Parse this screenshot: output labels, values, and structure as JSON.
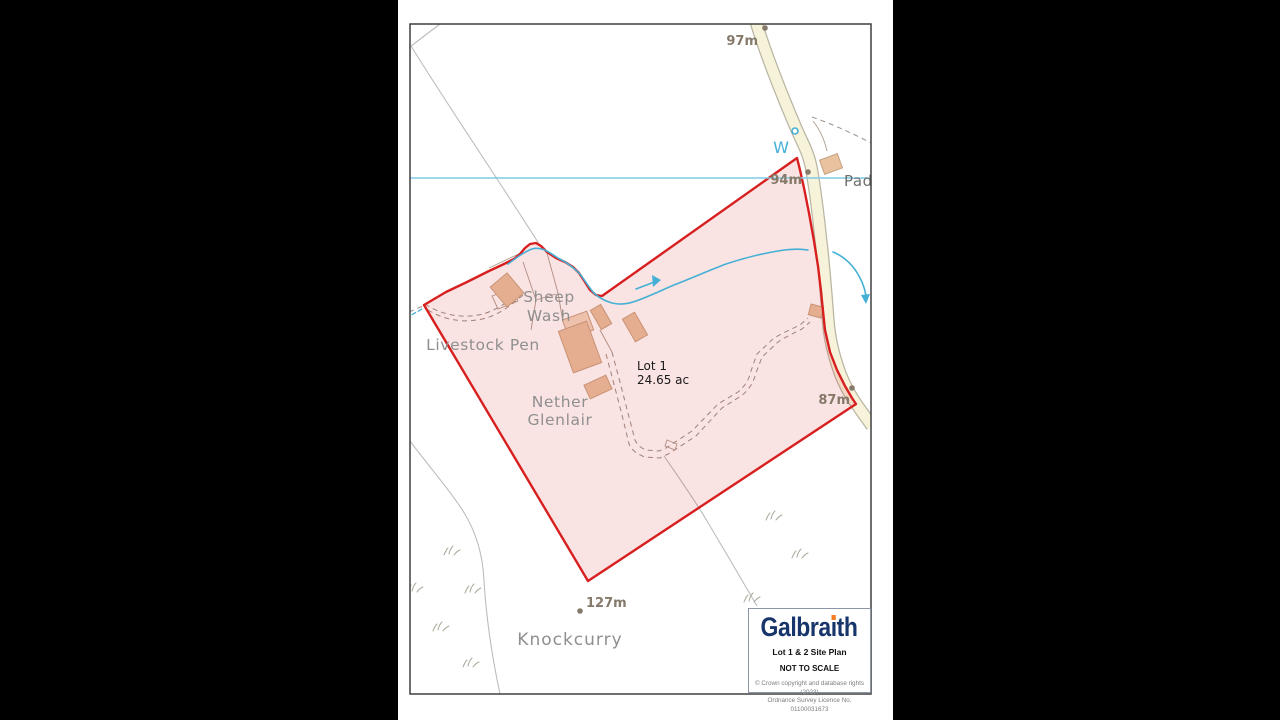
{
  "window": {
    "width": 1280,
    "height": 720,
    "background": "#000000"
  },
  "colors": {
    "red": "#d81f1f",
    "redfill": "rgba(216,40,40,0.13)",
    "road": "#f7f3da",
    "roadfill": "#f7f3da",
    "roadcase": "#b9b5a3",
    "water": "#45b0d6",
    "drain": "#7ecbe4",
    "fieldline": "#bcbcbc",
    "track": "#9a8f85",
    "detail": "#ab9c8d",
    "bldg": "#e9c3a0",
    "bldgline": "#c6a381",
    "bldglight": "#f2d8c0",
    "place": "#8f8f8f",
    "placedark": "#6e6e6e",
    "spot": "#85796a",
    "veg": "#a5a896",
    "border": "#3f3f3f",
    "navy": "#17356b",
    "orange": "#f47b20",
    "boxborder": "#8b95a5",
    "copy": "#7d7d7d"
  },
  "map": {
    "labels": [
      {
        "id": "sheep-wash-line1",
        "text": "Sheep",
        "x": 549,
        "y": 302,
        "anchor": "middle",
        "cls": "place"
      },
      {
        "id": "sheep-wash-line2",
        "text": "Wash",
        "x": 549,
        "y": 321,
        "anchor": "middle",
        "cls": "place"
      },
      {
        "id": "livestock-pen",
        "text": "Livestock Pen",
        "x": 483,
        "y": 350,
        "anchor": "middle",
        "cls": "place"
      },
      {
        "id": "nether-glenlair-line1",
        "text": "Nether",
        "x": 560,
        "y": 407,
        "anchor": "middle",
        "cls": "place"
      },
      {
        "id": "nether-glenlair-line2",
        "text": "Glenlair",
        "x": 560,
        "y": 425,
        "anchor": "middle",
        "cls": "place"
      },
      {
        "id": "knockcurry",
        "text": "Knockcurry",
        "x": 570,
        "y": 645,
        "anchor": "middle",
        "cls": "place big"
      },
      {
        "id": "padd",
        "text": "Padd",
        "x": 844,
        "y": 186,
        "anchor": "start",
        "cls": "place-dark"
      },
      {
        "id": "well-label",
        "text": "W",
        "x": 781,
        "y": 153,
        "anchor": "middle",
        "cls": "water-label"
      },
      {
        "id": "lot1-title",
        "text": "Lot 1",
        "x": 637,
        "y": 370,
        "anchor": "start",
        "cls": "lot"
      },
      {
        "id": "lot1-area",
        "text": "24.65 ac",
        "x": 637,
        "y": 384,
        "anchor": "start",
        "cls": "lot"
      }
    ],
    "spot_heights": [
      {
        "label": "97m",
        "dot": [
          765,
          28
        ],
        "text": [
          758,
          45
        ],
        "anchor": "end"
      },
      {
        "label": "94m",
        "dot": [
          808,
          172
        ],
        "text": [
          802,
          184
        ],
        "anchor": "end"
      },
      {
        "label": "87m",
        "dot": [
          852,
          388
        ],
        "text": [
          850,
          404
        ],
        "anchor": "end"
      },
      {
        "label": "127m",
        "dot": [
          580,
          611
        ],
        "text": [
          586,
          607
        ],
        "anchor": "start"
      }
    ],
    "well_marker": {
      "cx": 795,
      "cy": 131,
      "r": 3
    },
    "geometry": {
      "border": {
        "x": 410,
        "y": 24,
        "w": 461,
        "h": 670
      },
      "boundary_points": "797,158 800,170 804,188 809,213 814,241 818,266 821,291 823,311 825,330 830,352 837,370 845,386 852,398 856,404 588,581 424,305 446,292 467,282 489,271 504,264 514,259 520,254 525,248 530,244 536,243 541,246 547,252 556,258 565,262 573,267 579,273 585,282 590,290 596,295 602,296",
      "road_path": "M756,22 C766,55 782,95 796,128 C803,144 808,152 811,166 C815,188 818,212 821,241 C824,265 826,293 828,318 C829,334 833,354 840,373 C846,389 854,401 862,412 L872,426",
      "field_lines": [
        "M440,24 L411,46",
        "M411,46 C452,112 500,182 541,247",
        "M410,441 C426,463 450,490 463,511 C477,533 483,557 484,581 C486,613 491,652 500,694",
        "M664,456 C677,475 694,499 707,521 C723,548 742,580 757,606"
      ],
      "tracks": [
        "M425,304 C441,315 463,319 483,314 C497,310 511,300 521,291",
        "M428,310 C444,320 465,324 486,318 C500,314 513,304 523,295",
        "M612,352 L621,386 L629,417 L635,440 Q638,447 646,450 L659,451 L666,448 L692,431 L718,404 L738,392 Q748,384 751,371 L757,354 L774,338 L783,333 L800,325 L808,318",
        "M606,354 L615,388 L623,419 L629,444 Q633,453 645,457 L660,458 L670,453 L696,436 L722,408 L741,396 Q752,388 756,373 L762,357 L778,342 L786,337 L802,329 L810,322",
        "M812,117 C832,124 852,133 871,143",
        "M409,312 L423,306"
      ],
      "detail_lines": [
        "M489,268 L510,258 L521,253",
        "M492,296 L512,289 L518,301 L498,309 Z",
        "M523,262 L536,300 L531,330",
        "M536,300 L556,294",
        "M547,253 L558,293 L563,322 L574,318",
        "M600,330 L612,352",
        "M813,121 C821,131 825,142 827,151",
        "M667,440 L677,444 L675,450 L665,446 Z"
      ],
      "waters": [
        {
          "d": "M410,178 L871,178",
          "cls": "water drain"
        },
        {
          "d": "M508,264 C516,258 524,252 532,249 C542,246 550,253 558,258 C566,262 573,267 579,273 C585,280 589,288 594,293 C599,298 605,301 612,303 C620,305 628,304 636,301 C650,296 662,290 674,285 C692,278 710,270 726,264 C744,258 764,253 784,250 C793,249 802,249 808,250",
          "cls": "water"
        },
        {
          "d": "M833,252 C845,257 853,265 859,276 C863,283 866,292 866,299",
          "cls": "water"
        },
        {
          "d": "M636,289 L657,281",
          "cls": "water"
        },
        {
          "d": "M406,318 L422,309",
          "cls": "water dash"
        }
      ],
      "water_heads": [
        "M652,275 L661,280 L653,287 Z",
        "M861,295 L866,304 L870,294 Z"
      ],
      "buildings": [
        {
          "cx": 507,
          "cy": 290,
          "w": 22,
          "h": 26,
          "rot": -40,
          "light": false
        },
        {
          "cx": 578,
          "cy": 325,
          "w": 26,
          "h": 20,
          "rot": -20,
          "light": true
        },
        {
          "cx": 580,
          "cy": 347,
          "w": 30,
          "h": 44,
          "rot": -20,
          "light": false
        },
        {
          "cx": 601,
          "cy": 317,
          "w": 12,
          "h": 22,
          "rot": -30,
          "light": false
        },
        {
          "cx": 635,
          "cy": 327,
          "w": 14,
          "h": 26,
          "rot": -30,
          "light": false
        },
        {
          "cx": 598,
          "cy": 387,
          "w": 24,
          "h": 15,
          "rot": -25,
          "light": false
        },
        {
          "cx": 816,
          "cy": 311,
          "w": 13,
          "h": 11,
          "rot": 15,
          "light": false
        },
        {
          "cx": 831,
          "cy": 164,
          "w": 19,
          "h": 15,
          "rot": -20,
          "light": false
        }
      ],
      "tufts": [
        [
          450,
          553
        ],
        [
          413,
          590
        ],
        [
          471,
          591
        ],
        [
          439,
          629
        ],
        [
          469,
          665
        ],
        [
          772,
          518
        ],
        [
          798,
          556
        ],
        [
          750,
          600
        ]
      ]
    }
  },
  "legend": {
    "brand": "Galbraith",
    "brand_pre": "Galbra",
    "brand_i": "ı",
    "brand_post": "th",
    "plan_title": "Lot 1 & 2 Site Plan",
    "scale_note": "NOT TO SCALE",
    "copyright_line1": "© Crown copyright and database rights (2023)",
    "copyright_line2": "Ordnance Survey Licence No. 01100031673"
  }
}
